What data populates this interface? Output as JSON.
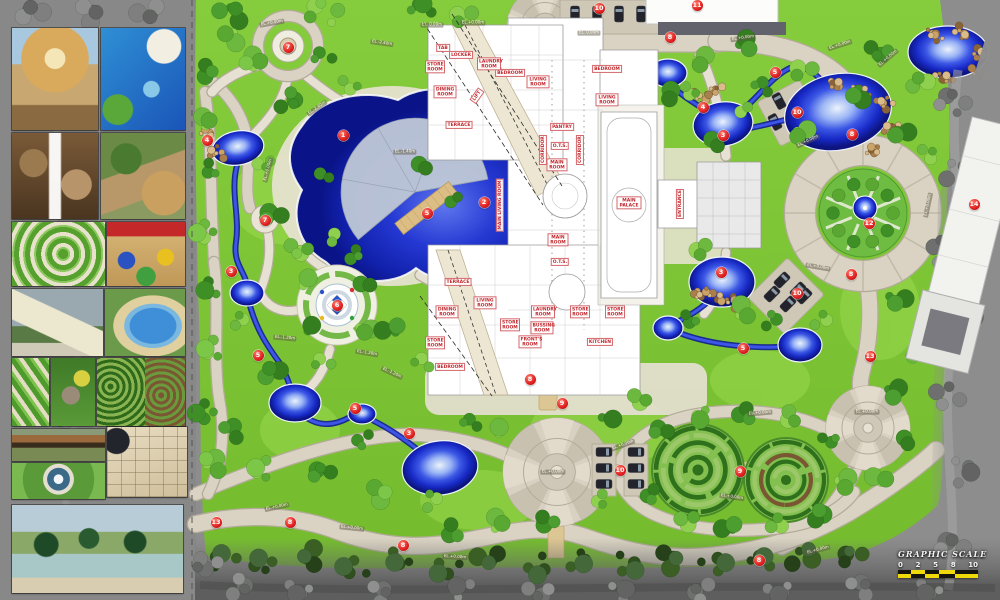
{
  "plan": {
    "markers": [
      {
        "n": "1",
        "x": 343,
        "y": 135
      },
      {
        "n": "2",
        "x": 484,
        "y": 202
      },
      {
        "n": "3",
        "x": 231,
        "y": 271
      },
      {
        "n": "3",
        "x": 409,
        "y": 433
      },
      {
        "n": "3",
        "x": 723,
        "y": 135
      },
      {
        "n": "3",
        "x": 721,
        "y": 272
      },
      {
        "n": "4",
        "x": 207,
        "y": 140
      },
      {
        "n": "4",
        "x": 703,
        "y": 107
      },
      {
        "n": "5",
        "x": 427,
        "y": 213
      },
      {
        "n": "5",
        "x": 258,
        "y": 355
      },
      {
        "n": "5",
        "x": 355,
        "y": 408
      },
      {
        "n": "5",
        "x": 775,
        "y": 72
      },
      {
        "n": "5",
        "x": 743,
        "y": 348
      },
      {
        "n": "6",
        "x": 337,
        "y": 305
      },
      {
        "n": "7",
        "x": 288,
        "y": 47
      },
      {
        "n": "7",
        "x": 265,
        "y": 220
      },
      {
        "n": "8",
        "x": 670,
        "y": 37
      },
      {
        "n": "8",
        "x": 852,
        "y": 134
      },
      {
        "n": "8",
        "x": 851,
        "y": 274
      },
      {
        "n": "8",
        "x": 530,
        "y": 379
      },
      {
        "n": "8",
        "x": 290,
        "y": 522
      },
      {
        "n": "8",
        "x": 403,
        "y": 545
      },
      {
        "n": "8",
        "x": 759,
        "y": 560
      },
      {
        "n": "9",
        "x": 562,
        "y": 403
      },
      {
        "n": "9",
        "x": 740,
        "y": 471
      },
      {
        "n": "10",
        "x": 599,
        "y": 8
      },
      {
        "n": "10",
        "x": 797,
        "y": 112
      },
      {
        "n": "10",
        "x": 797,
        "y": 293
      },
      {
        "n": "10",
        "x": 620,
        "y": 470
      },
      {
        "n": "11",
        "x": 697,
        "y": 5
      },
      {
        "n": "12",
        "x": 869,
        "y": 223
      },
      {
        "n": "13",
        "x": 216,
        "y": 522
      },
      {
        "n": "13",
        "x": 870,
        "y": 356
      },
      {
        "n": "14",
        "x": 974,
        "y": 204
      }
    ],
    "room_labels": [
      {
        "t": "BEDROOM",
        "x": 510,
        "y": 73
      },
      {
        "t": "LIVING ROOM",
        "x": 538,
        "y": 82,
        "w": 19
      },
      {
        "t": "BEDROOM",
        "x": 607,
        "y": 69
      },
      {
        "t": "LIVING ROOM",
        "x": 607,
        "y": 100,
        "w": 19
      },
      {
        "t": "DINING ROOM",
        "x": 445,
        "y": 92,
        "w": 19
      },
      {
        "t": "LIFT",
        "x": 477,
        "y": 96,
        "r": -55
      },
      {
        "t": "STORE ROOM",
        "x": 435,
        "y": 67,
        "w": 16
      },
      {
        "t": "LOCKER",
        "x": 461,
        "y": 55
      },
      {
        "t": "LAUNDRY ROOM",
        "x": 489,
        "y": 64,
        "w": 20
      },
      {
        "t": "TAB",
        "x": 443,
        "y": 48
      },
      {
        "t": "TERRACE",
        "x": 459,
        "y": 125
      },
      {
        "t": "PANTRY",
        "x": 562,
        "y": 127
      },
      {
        "t": "O.T.S.",
        "x": 560,
        "y": 146
      },
      {
        "t": "MAIN ROOM",
        "x": 557,
        "y": 165,
        "w": 17
      },
      {
        "t": "CORRIDOR",
        "x": 543,
        "y": 150,
        "r": -90
      },
      {
        "t": "CORRIDOR",
        "x": 580,
        "y": 150,
        "r": -90
      },
      {
        "t": "MAIN PALACE",
        "x": 629,
        "y": 203,
        "w": 21
      },
      {
        "t": "ENTRANCE",
        "x": 680,
        "y": 204,
        "r": -90
      },
      {
        "t": "MAIN LIVING ROOM",
        "x": 500,
        "y": 205,
        "r": -90,
        "w": 60
      },
      {
        "t": "TERRACE",
        "x": 458,
        "y": 282
      },
      {
        "t": "O.T.S.",
        "x": 560,
        "y": 262
      },
      {
        "t": "MAIN ROOM",
        "x": 558,
        "y": 240,
        "w": 17
      },
      {
        "t": "LIVING ROOM",
        "x": 485,
        "y": 303,
        "w": 19
      },
      {
        "t": "DINING ROOM",
        "x": 447,
        "y": 312,
        "w": 19
      },
      {
        "t": "LAUNDRY ROOM",
        "x": 543,
        "y": 312,
        "w": 20
      },
      {
        "t": "STORE ROOM",
        "x": 510,
        "y": 325,
        "w": 16
      },
      {
        "t": "BUSSING ROOM",
        "x": 542,
        "y": 328,
        "w": 19
      },
      {
        "t": "STORE ROOM",
        "x": 580,
        "y": 312,
        "w": 16
      },
      {
        "t": "STORE ROOM",
        "x": 615,
        "y": 312,
        "w": 16
      },
      {
        "t": "FRONT'S ROOM",
        "x": 530,
        "y": 342,
        "w": 19
      },
      {
        "t": "KITCHEN",
        "x": 600,
        "y": 342
      },
      {
        "t": "BEDROOM",
        "x": 450,
        "y": 367
      },
      {
        "t": "STORE ROOM",
        "x": 435,
        "y": 343,
        "w": 16
      }
    ],
    "elevation_labels": [
      {
        "t": "EL.+0.00m",
        "x": 272,
        "y": 23,
        "r": -10
      },
      {
        "t": "EL.-2.40m",
        "x": 382,
        "y": 43,
        "r": 8
      },
      {
        "t": "EL.-2.40m",
        "x": 317,
        "y": 108,
        "r": -35
      },
      {
        "t": "EL.+0.00m",
        "x": 268,
        "y": 170,
        "r": -75
      },
      {
        "t": "EL.-1.40m",
        "x": 405,
        "y": 152,
        "r": 0
      },
      {
        "t": "EL. 0.00m",
        "x": 432,
        "y": 25,
        "r": 0
      },
      {
        "t": "EL.+0.00m",
        "x": 473,
        "y": 23,
        "r": 0
      },
      {
        "t": "EL. 0.00m",
        "x": 589,
        "y": 33,
        "r": 0
      },
      {
        "t": "EL.+0.00m",
        "x": 743,
        "y": 38,
        "r": -8
      },
      {
        "t": "EL.+0.00m",
        "x": 840,
        "y": 45,
        "r": -18
      },
      {
        "t": "EL.+0.00m",
        "x": 888,
        "y": 58,
        "r": -40
      },
      {
        "t": "EL.+0.00m",
        "x": 808,
        "y": 141,
        "r": -25
      },
      {
        "t": "EL.+0.00m",
        "x": 928,
        "y": 205,
        "r": -78
      },
      {
        "t": "EL.+0.00m",
        "x": 818,
        "y": 267,
        "r": 10
      },
      {
        "t": "EL.-1.20m",
        "x": 285,
        "y": 338,
        "r": 5
      },
      {
        "t": "EL.-1.20m",
        "x": 367,
        "y": 353,
        "r": 10
      },
      {
        "t": "EL.-1.20m",
        "x": 392,
        "y": 373,
        "r": 25
      },
      {
        "t": "EL.+0.00m",
        "x": 553,
        "y": 472,
        "r": 0
      },
      {
        "t": "EL.+0.00m",
        "x": 867,
        "y": 412,
        "r": 0
      },
      {
        "t": "EL.+0.00m",
        "x": 277,
        "y": 507,
        "r": -12
      },
      {
        "t": "EL.+0.00m",
        "x": 352,
        "y": 528,
        "r": 6
      },
      {
        "t": "EL.+0.00m",
        "x": 455,
        "y": 557,
        "r": 3
      },
      {
        "t": "EL.+0.00m",
        "x": 760,
        "y": 413,
        "r": -5
      },
      {
        "t": "EL.+0.00m",
        "x": 623,
        "y": 445,
        "r": -20
      },
      {
        "t": "EL.+0.00m",
        "x": 732,
        "y": 497,
        "r": 8
      },
      {
        "t": "EL.+0.00m",
        "x": 818,
        "y": 550,
        "r": -15
      }
    ],
    "graphic_scale": {
      "title": "GRAPHIC SCALE",
      "ticks": [
        "0",
        "2",
        "5",
        "8",
        "10"
      ]
    }
  },
  "sidebar": {
    "reference_photos": [
      "gazebo pavilion",
      "pool with water slide",
      "rock waterfall",
      "garden stream",
      "spiral lawn",
      "children playground",
      "shade sails",
      "lagoon pool",
      "striped lawn rings",
      "rock garden",
      "hedge maze",
      "timber bridge",
      "garden fountain",
      "stone paving court",
      "palm resort lagoon"
    ]
  }
}
